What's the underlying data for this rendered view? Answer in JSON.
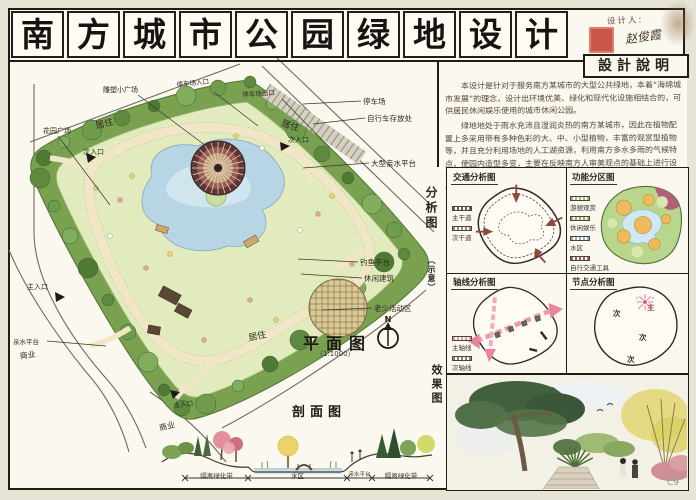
{
  "board": {
    "title_chars": [
      "南",
      "方",
      "城",
      "市",
      "公",
      "园",
      "绿",
      "地",
      "设",
      "计"
    ],
    "designer_label": "设计人:",
    "designer_name": "赵俊霞",
    "spec_heading": "設計說明",
    "description": [
      "本设计是针对于服务南方某城市的大型公共绿地，本着“海绵城市发展”的理念，设计出环境优美、绿化和现代化设施相结合的，可供居民休闲娱乐使用的城市休闲公园。",
      "绿地地处于雨水充沛且湿润炎热的南方某城市，因此在植物配置上多采用带有多种色彩的大、中、小型植物，丰富的观赏型植物等，并且充分利用场地的人工湖资源，利用南方多水多雨的气候特点，使园内造型多变，主要在反映南方人审美观点的基础上进行设计，满足游客审美需求，使市中心置身绿色环境中，以便于供游客休憩使用。"
    ],
    "watermark": "C9"
  },
  "plan": {
    "heading": "平面图",
    "scale": "（1:1000）",
    "north": "N",
    "labels": [
      {
        "text": "雕塑小广场",
        "x": 103,
        "y": 85,
        "size": 7,
        "leader": [
          138,
          95,
          206,
          146
        ]
      },
      {
        "text": "停车场入口",
        "x": 176,
        "y": 79,
        "size": 6.5,
        "rot": -6,
        "leader": [
          214,
          92,
          258,
          126
        ]
      },
      {
        "text": "停车场出口",
        "x": 242,
        "y": 89,
        "size": 6.5,
        "rot": -4,
        "leader": [
          282,
          99,
          330,
          148
        ]
      },
      {
        "text": "停车场",
        "x": 363,
        "y": 96,
        "size": 7.5,
        "leader": [
          361,
          101,
          303,
          104
        ]
      },
      {
        "text": "自行车存放处",
        "x": 367,
        "y": 113,
        "size": 7.5,
        "leader": [
          365,
          118,
          313,
          124
        ]
      },
      {
        "text": "居住",
        "x": 284,
        "y": 116,
        "size": 9,
        "rot": 18
      },
      {
        "text": "次入口",
        "x": 288,
        "y": 135,
        "size": 7
      },
      {
        "text": "大型亲水平台",
        "x": 371,
        "y": 158,
        "size": 7.5,
        "leader": [
          369,
          163,
          303,
          168
        ]
      },
      {
        "text": "居住",
        "x": 94,
        "y": 119,
        "size": 9,
        "rot": -14
      },
      {
        "text": "次入口",
        "x": 83,
        "y": 147,
        "size": 7
      },
      {
        "text": "花园广场",
        "x": 43,
        "y": 126,
        "size": 7,
        "leader": [
          58,
          136,
          110,
          205
        ]
      },
      {
        "text": "钓鱼平台",
        "x": 360,
        "y": 257,
        "size": 7.5,
        "leader": [
          358,
          262,
          298,
          259
        ]
      },
      {
        "text": "休闲建筑",
        "x": 364,
        "y": 273,
        "size": 7.5,
        "leader": [
          362,
          278,
          301,
          274
        ]
      },
      {
        "text": "老少活动区",
        "x": 374,
        "y": 303,
        "size": 7.5,
        "leader": [
          372,
          308,
          322,
          310
        ]
      },
      {
        "text": "居住",
        "x": 247,
        "y": 331,
        "size": 9,
        "rot": -12
      },
      {
        "text": "主入口",
        "x": 27,
        "y": 282,
        "size": 7
      },
      {
        "text": "亲水平台",
        "x": 13,
        "y": 336,
        "size": 6.5,
        "leader": [
          47,
          341,
          106,
          346
        ]
      },
      {
        "text": "商业",
        "x": 19,
        "y": 351,
        "size": 8,
        "rot": -8
      },
      {
        "text": "商业",
        "x": 158,
        "y": 423,
        "size": 8,
        "rot": -14
      },
      {
        "text": "主入口",
        "x": 173,
        "y": 400,
        "size": 6.5,
        "rot": -8
      }
    ]
  },
  "analysis": {
    "side_label": "分析图",
    "side_label_sub": "（示意）",
    "traffic": {
      "title": "交通分析图",
      "legend": [
        {
          "label": "主干道",
          "color": "#7a5a4a"
        },
        {
          "label": "次干道",
          "color": "#a08a72"
        }
      ]
    },
    "function": {
      "title": "功能分区图",
      "legend": [
        {
          "label": "游憩观赏",
          "color": "#9cc46a"
        },
        {
          "label": "休闲娱乐",
          "color": "#c99a5e"
        },
        {
          "label": "水区",
          "color": "#8fb3c4"
        },
        {
          "label": "自行交通工具",
          "color": "#a85a4e"
        }
      ]
    },
    "axis": {
      "title": "轴线分析图",
      "legend": [
        {
          "label": "主轴线",
          "color": "#ef9ab0"
        },
        {
          "label": "次轴线",
          "color": "#8a8578"
        }
      ]
    },
    "node": {
      "title": "节点分析图",
      "markers": [
        {
          "t": "主",
          "x": 60,
          "y": 30,
          "main": true
        },
        {
          "t": "次",
          "x": 26,
          "y": 36
        },
        {
          "t": "次",
          "x": 52,
          "y": 60
        },
        {
          "t": "次",
          "x": 40,
          "y": 82
        }
      ]
    }
  },
  "section": {
    "heading": "剖面图",
    "segments": [
      "隔离绿化带",
      "水区",
      "亲水平台",
      "隔离绿化带"
    ]
  },
  "effect": {
    "side_label": "效果图"
  }
}
